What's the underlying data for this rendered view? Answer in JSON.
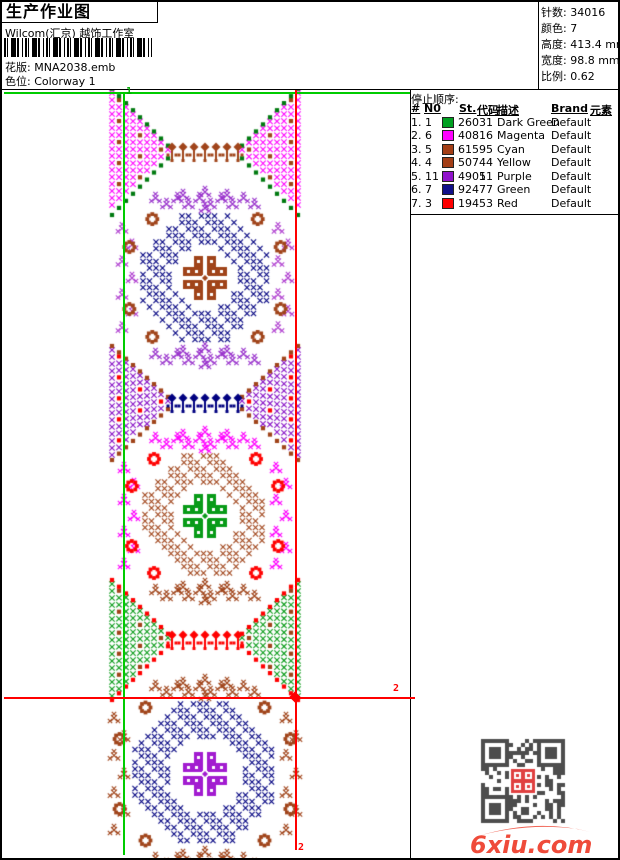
{
  "header": {
    "title": "生产作业图",
    "company": "Wilcom(汇京) 越饰工作室",
    "barcode_icon": "barcode",
    "fields": [
      {
        "label": "花版:",
        "value": "MNA2038.emb"
      },
      {
        "label": "色位:",
        "value": "Colorway 1"
      }
    ]
  },
  "stats": {
    "rows": [
      {
        "label": "针数:",
        "value": "34016"
      },
      {
        "label": "颜色:",
        "value": "7"
      },
      {
        "label": "高度:",
        "value": "413.4 mm"
      },
      {
        "label": "宽度:",
        "value": "98.8 mm"
      },
      {
        "label": "比例:",
        "value": "0.62"
      }
    ]
  },
  "sequence_panel": {
    "title": "停止顺序:",
    "columns": [
      {
        "label": "#",
        "x": 0
      },
      {
        "label": "N0",
        "x": 13
      },
      {
        "label": "St.",
        "x": 48
      },
      {
        "label": "代码",
        "x": 66
      },
      {
        "label": "描述",
        "x": 86
      },
      {
        "label": "Brand",
        "x": 140
      },
      {
        "label": "元素",
        "x": 179
      }
    ],
    "rows": [
      {
        "no": "1. 1",
        "swatch": "#00a021",
        "st": "2603",
        "code": "1",
        "desc": "Dark Green",
        "brand": "Default",
        "element": ""
      },
      {
        "no": "2. 6",
        "swatch": "#ff00ff",
        "st": "4081",
        "code": "6",
        "desc": "Magenta",
        "brand": "Default",
        "element": ""
      },
      {
        "no": "3. 5",
        "swatch": "#a33e16",
        "st": "6159",
        "code": "5",
        "desc": "Cyan",
        "brand": "Default",
        "element": ""
      },
      {
        "no": "4. 4",
        "swatch": "#a33e16",
        "st": "5074",
        "code": "4",
        "desc": "Yellow",
        "brand": "Default",
        "element": ""
      },
      {
        "no": "5. 11",
        "swatch": "#9113cc",
        "st": "4905",
        "code": "11",
        "desc": "Purple",
        "brand": "Default",
        "element": ""
      },
      {
        "no": "6. 7",
        "swatch": "#10108a",
        "st": "9247",
        "code": "7",
        "desc": "Green",
        "brand": "Default",
        "element": ""
      },
      {
        "no": "7. 3",
        "swatch": "#ff0000",
        "st": "1945",
        "code": "3",
        "desc": "Red",
        "brand": "Default",
        "element": ""
      }
    ]
  },
  "design": {
    "cx": 203,
    "xL": 110,
    "xR": 296,
    "palette": {
      "magenta": "#ff00ff",
      "green": "#089b18",
      "dgreen": "#007a10",
      "brown": "#a0441a",
      "navy": "#000080",
      "purple": "#8812c6",
      "purple2": "#a21cd0",
      "violet": "#b040d0",
      "orchid": "#9933cc",
      "red": "#ff0000"
    },
    "motifs": [
      {
        "type": "hourglass",
        "cy": 150,
        "h": 118,
        "fill": "magenta",
        "edge": "dgreen",
        "accent": "brown",
        "trees": "brown"
      },
      {
        "type": "medallion",
        "cy": 276,
        "R": 62,
        "ring": "navy",
        "center": "brown",
        "side": "violet",
        "corner": "brown",
        "crownTop": "orchid",
        "crownBottom": "orchid"
      },
      {
        "type": "hourglass",
        "cy": 401,
        "h": 106,
        "fill": "purple",
        "edge": "brown",
        "accent": "red",
        "trees": "navy"
      },
      {
        "type": "medallion",
        "cy": 514,
        "R": 60,
        "ring": "brown",
        "center": "green",
        "side": "magenta",
        "corner": "red",
        "crownTop": "magenta",
        "crownBottom": "brown"
      },
      {
        "type": "hourglass",
        "cy": 638,
        "h": 112,
        "fill": "green",
        "edge": "red",
        "accent": "brown",
        "trees": "red"
      },
      {
        "type": "medallion",
        "cy": 772,
        "R": 70,
        "ring": "navy",
        "center": "purple2",
        "side": "brown",
        "corner": "brown",
        "crownTop": "brown",
        "crownBottom": "brown"
      }
    ],
    "guide_lines": [
      {
        "kind": "h",
        "y": 90,
        "x1": 2,
        "x2": 408,
        "color": "#00cc00",
        "name": "green-top-guide"
      },
      {
        "kind": "v",
        "x": 121,
        "y1": 90,
        "y2": 853,
        "color": "#00cc00",
        "name": "green-vertical-guide"
      },
      {
        "kind": "v",
        "x": 293,
        "y1": 88,
        "y2": 848,
        "color": "#ff0000",
        "name": "red-vertical-guide"
      },
      {
        "kind": "h",
        "y": 695,
        "x1": 2,
        "x2": 413,
        "color": "#ff0000",
        "name": "red-horizontal-guide"
      }
    ],
    "markers": [
      {
        "text": "1",
        "x": 124,
        "y": 84,
        "color": "#00aa00"
      },
      {
        "text": "2",
        "x": 391,
        "y": 681,
        "color": "#ff0000"
      },
      {
        "text": "2",
        "x": 296,
        "y": 840,
        "color": "#ff0000"
      }
    ]
  },
  "watermark": {
    "qr_icon": "qr-code",
    "qr_dark": "#4d4d4d",
    "seal_color": "#e04040",
    "logo": "6xiu.com",
    "logo_color": "#ef4b3a"
  }
}
